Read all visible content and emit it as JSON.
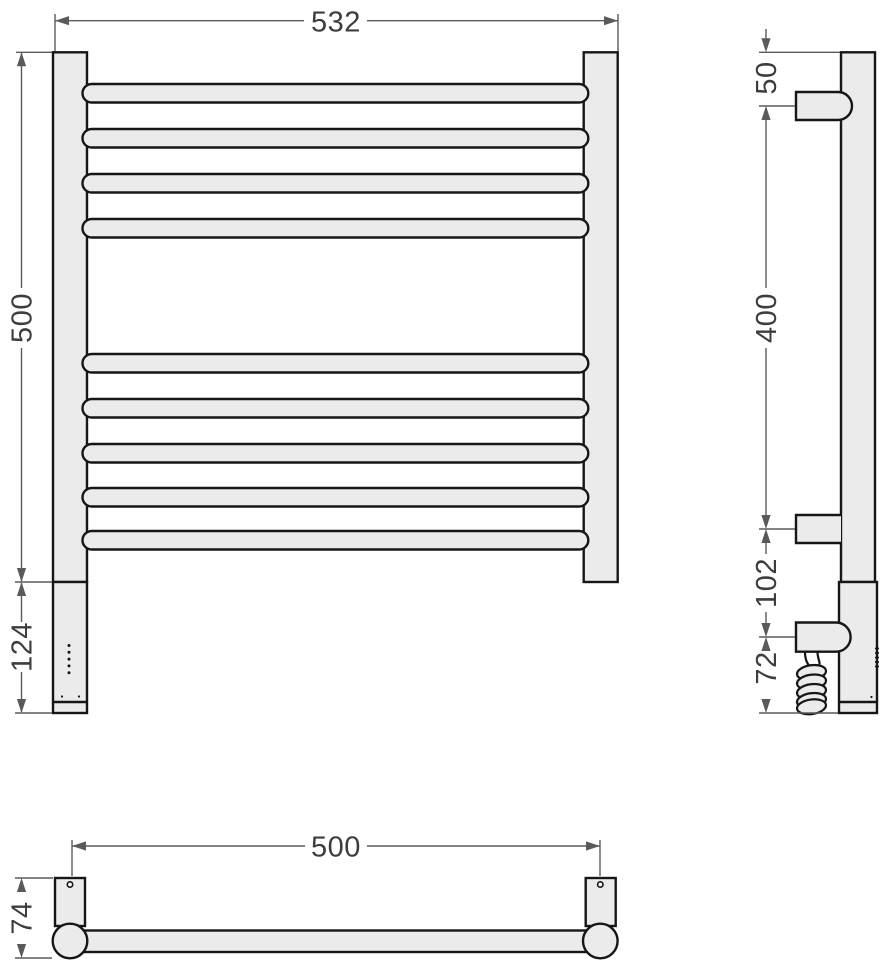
{
  "dimensions": {
    "front": {
      "width": "532",
      "height": "500",
      "heater_section": "124"
    },
    "side": {
      "top_bracket_offset": "50",
      "bracket_spacing": "400",
      "heater_bracket_offset": "102",
      "cable_drop": "72"
    },
    "bottom": {
      "mount_spacing": "500",
      "depth": "74"
    }
  },
  "colors": {
    "fill": "#ebebeb",
    "outline": "#161616",
    "dimension": "#5a5a5a",
    "label": "#3d3d3d",
    "background": "#ffffff"
  }
}
